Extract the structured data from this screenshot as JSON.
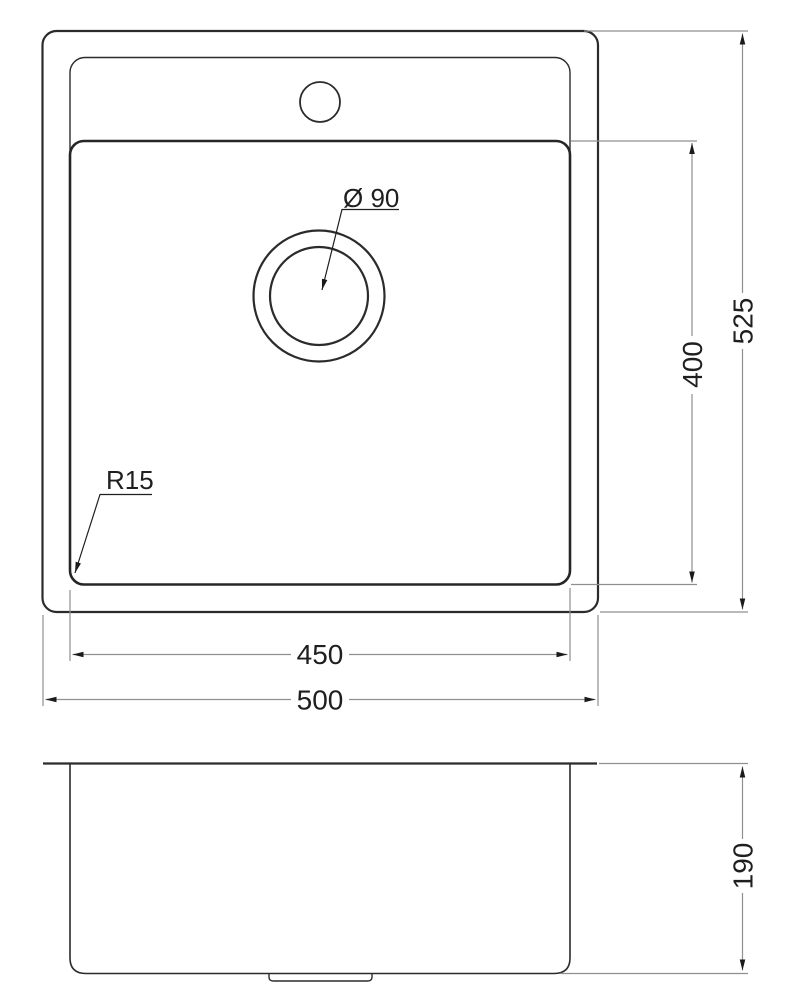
{
  "colors": {
    "background": "#ffffff",
    "outline": "#2b2b2b",
    "dimension_lines": "#8f8f8f",
    "arrows_and_text": "#1f1f1f"
  },
  "top_view": {
    "labels": {
      "overall_depth": "525",
      "bowl_depth": "400",
      "bowl_width": "450",
      "overall_width": "500",
      "drain_diameter": "Ø 90",
      "corner_radius": "R15"
    }
  },
  "side_view": {
    "labels": {
      "height": "190"
    }
  }
}
